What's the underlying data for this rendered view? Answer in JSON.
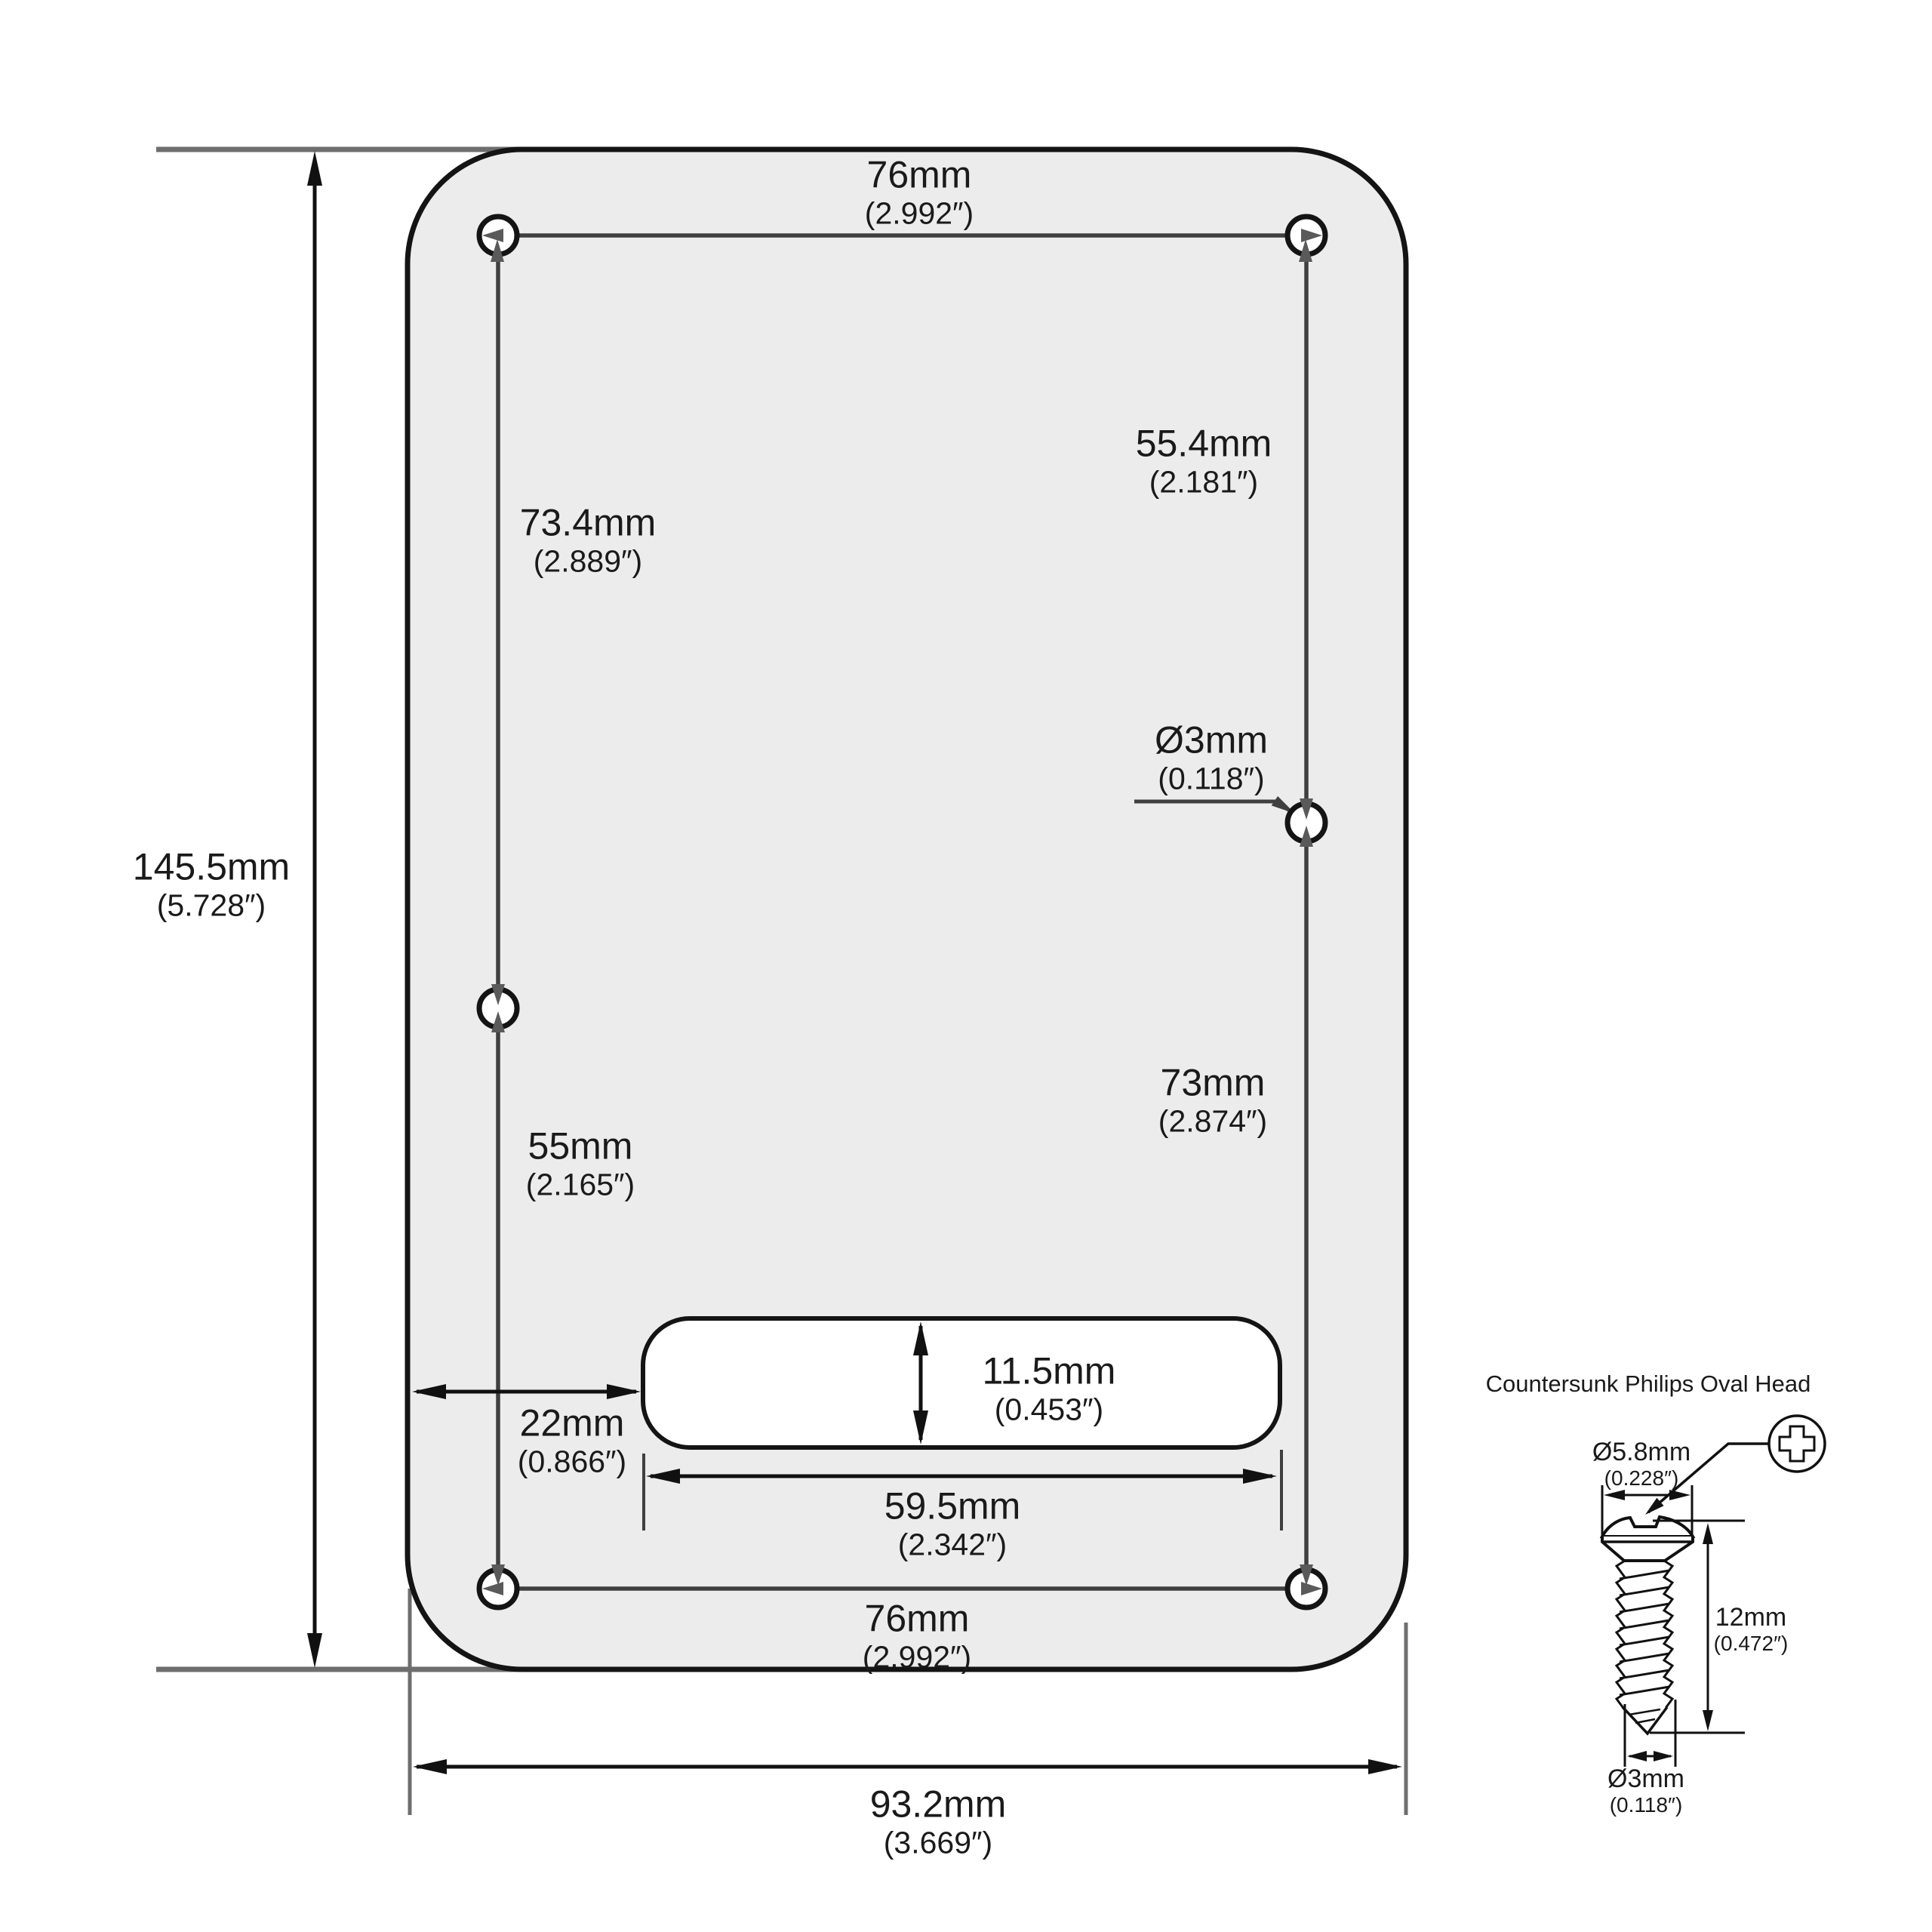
{
  "colors": {
    "background": "#ffffff",
    "plate_fill": "#ececec",
    "outline": "#141414",
    "dim_line": "#3f3f3f",
    "extension_line": "#6e6e6e",
    "black_dim": "#111111",
    "hole_arrow": "#5a5a5a",
    "text": "#1a1a1a"
  },
  "plate": {
    "top_width": {
      "mm": "76mm",
      "in": "(2.992″)"
    },
    "upper_left_spacing": {
      "mm": "73.4mm",
      "in": "(2.889″)"
    },
    "upper_right_spacing": {
      "mm": "55.4mm",
      "in": "(2.181″)"
    },
    "hole_diameter": {
      "mm": "Ø3mm",
      "in": "(0.118″)"
    },
    "overall_height": {
      "mm": "145.5mm",
      "in": "(5.728″)"
    },
    "lower_left_spacing": {
      "mm": "55mm",
      "in": "(2.165″)"
    },
    "lower_right_spacing": {
      "mm": "73mm",
      "in": "(2.874″)"
    },
    "slot_height": {
      "mm": "11.5mm",
      "in": "(0.453″)"
    },
    "edge_to_slot": {
      "mm": "22mm",
      "in": "(0.866″)"
    },
    "slot_width": {
      "mm": "59.5mm",
      "in": "(2.342″)"
    },
    "bottom_width": {
      "mm": "76mm",
      "in": "(2.992″)"
    },
    "overall_width": {
      "mm": "93.2mm",
      "in": "(3.669″)"
    }
  },
  "screw": {
    "title": "Countersunk Philips Oval Head",
    "head_diameter": {
      "mm": "Ø5.8mm",
      "in": "(0.228″)"
    },
    "length": {
      "mm": "12mm",
      "in": "(0.472″)"
    },
    "thread_diameter": {
      "mm": "Ø3mm",
      "in": "(0.118″)"
    }
  }
}
